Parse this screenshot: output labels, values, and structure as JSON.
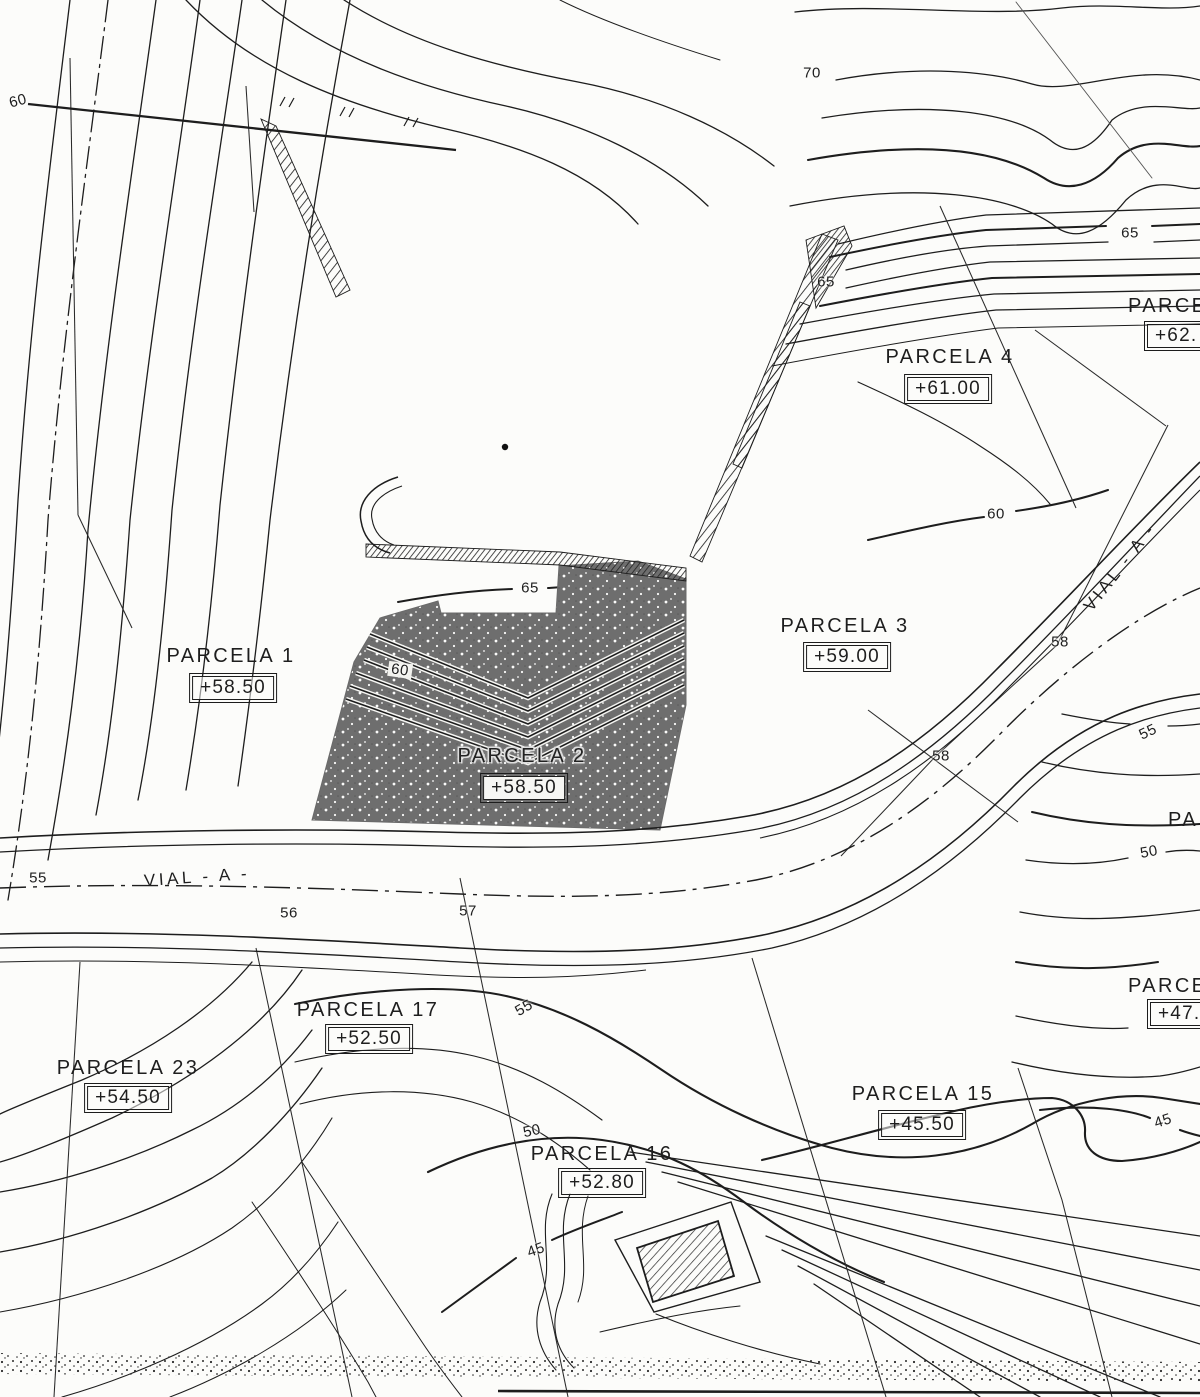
{
  "map": {
    "type": "cadastral-site-plan",
    "background_color": "#fcfcfa",
    "ink_color": "#1d1d1d",
    "shaded_parcel_color": "#6e6e6e"
  },
  "parcels": [
    {
      "name": "PARCELA 1",
      "elevation": "+58.50",
      "name_pos": {
        "x": 231,
        "y": 656
      },
      "elev_pos": {
        "x": 233,
        "y": 688
      }
    },
    {
      "name": "PARCELA 2",
      "elevation": "+58.50",
      "name_pos": {
        "x": 522,
        "y": 756
      },
      "elev_pos": {
        "x": 524,
        "y": 788
      },
      "dark": true
    },
    {
      "name": "PARCELA 3",
      "elevation": "+59.00",
      "name_pos": {
        "x": 845,
        "y": 626
      },
      "elev_pos": {
        "x": 847,
        "y": 657
      }
    },
    {
      "name": "PARCELA 4",
      "elevation": "+61.00",
      "name_pos": {
        "x": 950,
        "y": 357
      },
      "elev_pos": {
        "x": 948,
        "y": 389
      }
    },
    {
      "name": "PARCE",
      "elevation": "+62.",
      "name_pos": {
        "x": 1128,
        "y": 296
      },
      "elev_pos": {
        "x": 1147,
        "y": 324
      },
      "clipped": true
    },
    {
      "name": "PARCELA 15",
      "elevation": "+45.50",
      "name_pos": {
        "x": 923,
        "y": 1094
      },
      "elev_pos": {
        "x": 922,
        "y": 1125
      }
    },
    {
      "name": "PARCELA 16",
      "elevation": "+52.80",
      "name_pos": {
        "x": 602,
        "y": 1154
      },
      "elev_pos": {
        "x": 602,
        "y": 1183
      }
    },
    {
      "name": "PARCELA 17",
      "elevation": "+52.50",
      "name_pos": {
        "x": 368,
        "y": 1010
      },
      "elev_pos": {
        "x": 369,
        "y": 1039
      }
    },
    {
      "name": "PARCELA 23",
      "elevation": "+54.50",
      "name_pos": {
        "x": 128,
        "y": 1068
      },
      "elev_pos": {
        "x": 128,
        "y": 1098
      }
    },
    {
      "name": "PARCE",
      "elevation": "+47.",
      "name_pos": {
        "x": 1128,
        "y": 976
      },
      "elev_pos": {
        "x": 1150,
        "y": 1002
      },
      "clipped": true
    },
    {
      "name": "PA",
      "elevation": null,
      "name_pos": {
        "x": 1168,
        "y": 810
      },
      "clipped": true
    }
  ],
  "contour_labels": [
    {
      "text": "60",
      "x": 18,
      "y": 101,
      "rot": -15
    },
    {
      "text": "70",
      "x": 812,
      "y": 73,
      "rot": 0
    },
    {
      "text": "65",
      "x": 1130,
      "y": 233,
      "rot": 0
    },
    {
      "text": "65",
      "x": 826,
      "y": 282,
      "rot": 0
    },
    {
      "text": "60",
      "x": 996,
      "y": 514,
      "rot": 0
    },
    {
      "text": "65",
      "x": 530,
      "y": 588,
      "rot": 0
    },
    {
      "text": "60",
      "x": 400,
      "y": 670,
      "rot": 8,
      "chip": true
    },
    {
      "text": "58",
      "x": 1060,
      "y": 642,
      "rot": 0
    },
    {
      "text": "55",
      "x": 1148,
      "y": 732,
      "rot": -25
    },
    {
      "text": "58",
      "x": 941,
      "y": 756,
      "rot": 0
    },
    {
      "text": "50",
      "x": 1149,
      "y": 852,
      "rot": -10
    },
    {
      "text": "55",
      "x": 38,
      "y": 878,
      "rot": 0
    },
    {
      "text": "56",
      "x": 289,
      "y": 913,
      "rot": 0
    },
    {
      "text": "57",
      "x": 468,
      "y": 911,
      "rot": 0
    },
    {
      "text": "55",
      "x": 524,
      "y": 1008,
      "rot": -30
    },
    {
      "text": "50",
      "x": 532,
      "y": 1131,
      "rot": -12
    },
    {
      "text": "45",
      "x": 1163,
      "y": 1121,
      "rot": -18
    },
    {
      "text": "45",
      "x": 536,
      "y": 1250,
      "rot": -20
    }
  ],
  "road_labels": [
    {
      "text": "VIAL - A -",
      "x": 197,
      "y": 877,
      "rot": -4
    },
    {
      "text": "VIAL - A -",
      "x": 1120,
      "y": 567,
      "rot": -52
    }
  ]
}
